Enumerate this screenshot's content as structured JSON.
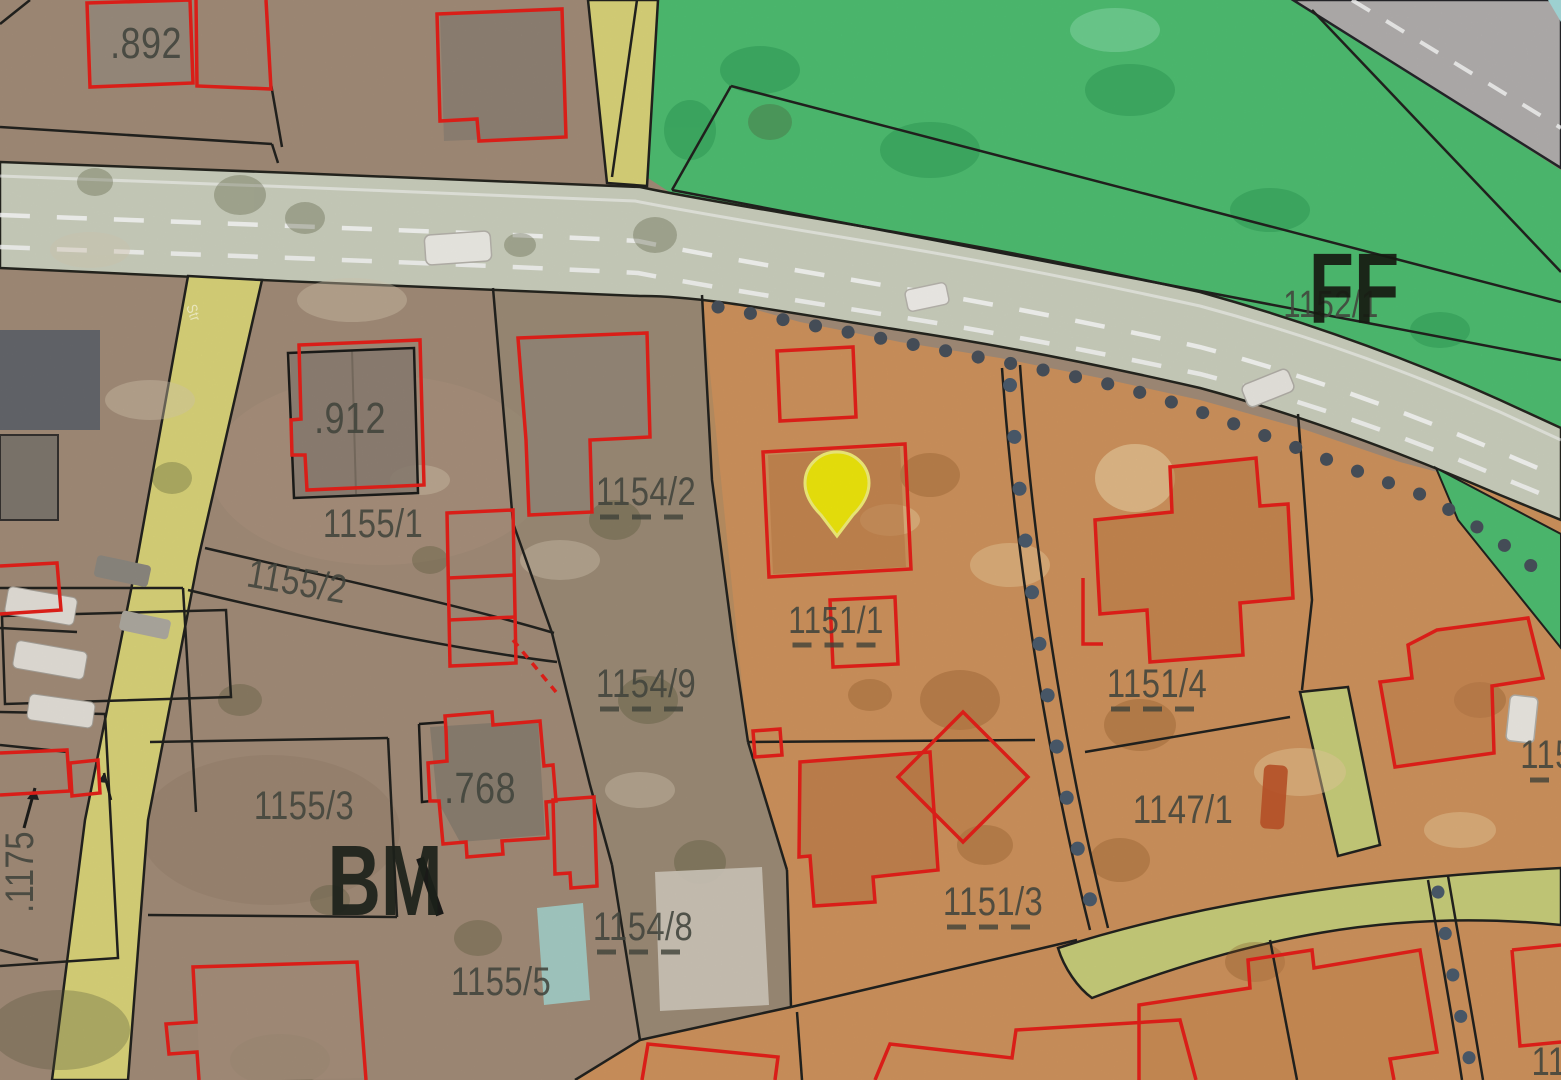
{
  "app": {
    "view": "cadastral-zoning-map"
  },
  "map": {
    "zones_visible": [
      "BM",
      "FF"
    ],
    "marker": {
      "name": "location-pin",
      "fill": "#f2ea0c",
      "x": 837,
      "y": 493
    },
    "colors": {
      "parcel_brown": "#a58e7a",
      "parcel_orange": "#d2955e",
      "grassland_green": "#4fc173",
      "road_main": "#ced3c1",
      "road_gray": "#b5b2b0",
      "path_yellow": "#ddd77b",
      "path_olive": "#cbd07c",
      "building_outline_red": "#e8211a",
      "boundary_black": "#23231f",
      "dot_slate": "#4b5560",
      "label_gray": "#41443c",
      "pool_blue": "#a7cec7",
      "corner_cyan": "#a8dede"
    },
    "labels": [
      {
        "text": ".892",
        "x": 146,
        "y": 44,
        "size": 44
      },
      {
        "text": ".912",
        "x": 350,
        "y": 419,
        "size": 44
      },
      {
        "text": "1155/1",
        "x": 373,
        "y": 524,
        "size": 40
      },
      {
        "text": "1155/2",
        "x": 297,
        "y": 582,
        "size": 40,
        "rot": 10
      },
      {
        "text": "1154/2",
        "x": 646,
        "y": 492,
        "size": 40,
        "dash": true
      },
      {
        "text": "1151/1",
        "x": 836,
        "y": 621,
        "size": 38,
        "dash": true
      },
      {
        "text": "1154/9",
        "x": 646,
        "y": 684,
        "size": 40,
        "dash": true
      },
      {
        "text": ".768",
        "x": 480,
        "y": 789,
        "size": 44
      },
      {
        "text": "1155/3",
        "x": 304,
        "y": 806,
        "size": 40
      },
      {
        "text": "1154/8",
        "x": 643,
        "y": 927,
        "size": 40,
        "dash": true
      },
      {
        "text": "1155/5",
        "x": 501,
        "y": 982,
        "size": 40
      },
      {
        "text": "1151/3",
        "x": 993,
        "y": 902,
        "size": 40,
        "dash": true
      },
      {
        "text": "1151/4",
        "x": 1157,
        "y": 684,
        "size": 40,
        "dash": true
      },
      {
        "text": "1147/1",
        "x": 1183,
        "y": 810,
        "size": 40
      },
      {
        "text": "1152/1",
        "x": 1331,
        "y": 305,
        "size": 38
      },
      {
        "text": "FF",
        "x": 1354,
        "y": 289,
        "size": 100,
        "zone": true,
        "color": "#161b12"
      },
      {
        "text": "BM",
        "x": 385,
        "y": 881,
        "size": 100,
        "zone": true,
        "color": "#1c211a"
      },
      {
        "text": ".1175",
        "x": 20,
        "y": 872,
        "size": 40,
        "rot": -90
      },
      {
        "text": "115",
        "x": 1547,
        "y": 755,
        "size": 40,
        "dash": true,
        "dashW": 34
      },
      {
        "text": "11",
        "x": 1549,
        "y": 1062,
        "size": 40
      },
      {
        "text": "Str",
        "x": 193,
        "y": 313,
        "size": 15,
        "rot": 72,
        "color": "rgba(255,255,255,0.6)"
      }
    ]
  }
}
